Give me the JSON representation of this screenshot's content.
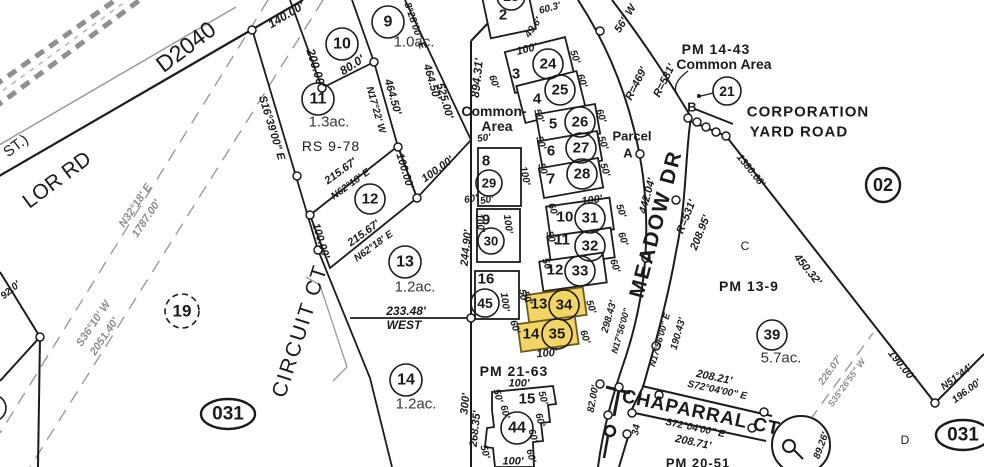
{
  "canvas": {
    "width": 984,
    "height": 467
  },
  "colors": {
    "ink": "#1b1b1b",
    "gray_line": "#9a9a9a",
    "gray_text": "#8c8c8c",
    "acre_text": "#383838",
    "highlight_fill": "#f2d469",
    "highlight_stroke": "#6b5a1d"
  },
  "map_names": {
    "roads": [
      "D2040",
      "LOR RD",
      "ST.)",
      "MEADOW DR",
      "CIRCUIT CT",
      "CHAPARRAL CT",
      "CORPORATION YARD ROAD"
    ],
    "references": [
      "PM 14-43",
      "PM 13-9",
      "PM 21-63",
      "PM 20-51",
      "RS 9-78"
    ],
    "highlighted_parcels": [
      "34",
      "35"
    ]
  },
  "parcel_circles": [
    {
      "n": "9",
      "x": 388,
      "y": 22,
      "r": 16
    },
    {
      "n": "10",
      "x": 342,
      "y": 44,
      "r": 16
    },
    {
      "n": "11",
      "x": 318,
      "y": 99,
      "r": 16
    },
    {
      "n": "12",
      "x": 370,
      "y": 199,
      "r": 15
    },
    {
      "n": "13",
      "x": 405,
      "y": 262,
      "r": 16
    },
    {
      "n": "14",
      "x": 406,
      "y": 380,
      "r": 16
    },
    {
      "n": "19",
      "x": 182,
      "y": 311,
      "r": 17,
      "dash": 1
    },
    {
      "n": "21",
      "x": 727,
      "y": 91,
      "r": 14
    },
    {
      "n": "23",
      "x": 511,
      "y": -4,
      "r": 14
    },
    {
      "n": "24",
      "x": 548,
      "y": 64,
      "r": 15
    },
    {
      "n": "25",
      "x": 560,
      "y": 90,
      "r": 15
    },
    {
      "n": "26",
      "x": 580,
      "y": 122,
      "r": 15
    },
    {
      "n": "27",
      "x": 581,
      "y": 148,
      "r": 15
    },
    {
      "n": "28",
      "x": 582,
      "y": 174,
      "r": 15
    },
    {
      "n": "29",
      "x": 489,
      "y": 183,
      "r": 13
    },
    {
      "n": "30",
      "x": 491,
      "y": 241,
      "r": 13
    },
    {
      "n": "31",
      "x": 590,
      "y": 218,
      "r": 15
    },
    {
      "n": "32",
      "x": 590,
      "y": 246,
      "r": 15
    },
    {
      "n": "33",
      "x": 580,
      "y": 271,
      "r": 15
    },
    {
      "n": "34",
      "x": 564,
      "y": 305,
      "r": 15,
      "hl": 1
    },
    {
      "n": "35",
      "x": 557,
      "y": 334,
      "r": 15,
      "hl": 1
    },
    {
      "n": "39",
      "x": 772,
      "y": 335,
      "r": 15
    },
    {
      "n": "44",
      "x": 517,
      "y": 428,
      "r": 16
    },
    {
      "n": "45",
      "x": 485,
      "y": 303,
      "r": 14
    },
    {
      "n": "02",
      "x": 883,
      "y": 185,
      "r": 17,
      "big": 1
    },
    {
      "n": "",
      "x": -7,
      "y": 408,
      "r": 13
    }
  ],
  "ellipse_badges": [
    {
      "n": "031",
      "x": 228,
      "y": 414,
      "rx": 27,
      "ry": 15
    },
    {
      "n": "031",
      "x": 963,
      "y": 435,
      "rx": 27,
      "ry": 15
    }
  ],
  "lots": [
    {
      "id": "2",
      "x": 486,
      "y": -8,
      "w": 46,
      "h": 42,
      "rot": -12
    },
    {
      "id": "3",
      "x": 509,
      "y": 44,
      "w": 62,
      "h": 42,
      "rot": -14
    },
    {
      "id": "4",
      "x": 520,
      "y": 78,
      "w": 62,
      "h": 38,
      "rot": -14
    },
    {
      "id": "5",
      "x": 538,
      "y": 109,
      "w": 60,
      "h": 30,
      "rot": -10
    },
    {
      "id": "6",
      "x": 540,
      "y": 136,
      "w": 60,
      "h": 30,
      "rot": -10
    },
    {
      "id": "7",
      "x": 541,
      "y": 163,
      "w": 60,
      "h": 30,
      "rot": -10
    },
    {
      "id": "8",
      "x": 478,
      "y": 148,
      "w": 43,
      "h": 58,
      "rot": 0
    },
    {
      "id": "9",
      "x": 477,
      "y": 209,
      "w": 43,
      "h": 53,
      "rot": 0
    },
    {
      "id": "16",
      "x": 475,
      "y": 271,
      "w": 44,
      "h": 48,
      "rot": 0
    },
    {
      "id": "10",
      "x": 548,
      "y": 202,
      "w": 64,
      "h": 32,
      "rot": -8
    },
    {
      "id": "11",
      "x": 549,
      "y": 232,
      "w": 64,
      "h": 30,
      "rot": -8
    },
    {
      "id": "12",
      "x": 541,
      "y": 257,
      "w": 64,
      "h": 30,
      "rot": -8
    },
    {
      "id": "13",
      "x": 527,
      "y": 291,
      "w": 58,
      "h": 28,
      "rot": -8,
      "hl": 1
    },
    {
      "id": "14",
      "x": 519,
      "y": 320,
      "w": 58,
      "h": 28,
      "rot": -8,
      "hl": 1
    },
    {
      "id": "15",
      "poly": "492,392 553,386 556,404 548,405 550,422 541,423 543,441 533,442 534,467 495,467 493,448 485,447 487,428 494,427 492,410"
    }
  ],
  "labels": [
    {
      "t": "D2040",
      "x": 186,
      "y": 47,
      "r": -37,
      "s": 23,
      "k": "plain"
    },
    {
      "t": "ST.)",
      "x": 16,
      "y": 146,
      "r": -37,
      "s": 15,
      "k": "plain"
    },
    {
      "t": "LOR RD",
      "x": 57,
      "y": 180,
      "r": -37,
      "s": 21,
      "k": "plain"
    },
    {
      "t": "CIRCUIT  CT",
      "x": 300,
      "y": 331,
      "r": -72,
      "s": 21,
      "k": "plain",
      "ls": 2
    },
    {
      "t": "MEADOW  DR",
      "x": 656,
      "y": 224,
      "r": -75,
      "s": 21,
      "k": "name",
      "ls": 2
    },
    {
      "t": "CHAPARRAL  CT",
      "x": 701,
      "y": 413,
      "r": 12,
      "s": 19,
      "k": "name",
      "ls": 1
    },
    {
      "t": "CORPORATION",
      "x": 808,
      "y": 112,
      "s": 15,
      "k": "name",
      "ls": 1
    },
    {
      "t": "YARD ROAD",
      "x": 799,
      "y": 132,
      "s": 15,
      "k": "name",
      "ls": 1
    },
    {
      "t": "PM 14-43",
      "x": 716,
      "y": 49,
      "s": 14,
      "k": "name",
      "ls": 1
    },
    {
      "t": "Common Area",
      "x": 724,
      "y": 64,
      "s": 14,
      "k": "name"
    },
    {
      "t": "Common-",
      "x": 494,
      "y": 111,
      "s": 14,
      "k": "name"
    },
    {
      "t": "Area",
      "x": 497,
      "y": 126,
      "s": 14,
      "k": "name"
    },
    {
      "t": "Parcel",
      "x": 632,
      "y": 136,
      "s": 13,
      "k": "name"
    },
    {
      "t": "A",
      "x": 628,
      "y": 153,
      "s": 13,
      "k": "name"
    },
    {
      "t": "PM 13-9",
      "x": 749,
      "y": 286,
      "s": 14,
      "k": "name",
      "ls": 1
    },
    {
      "t": "PM 21-63",
      "x": 514,
      "y": 371,
      "s": 14,
      "k": "name",
      "ls": 1
    },
    {
      "t": "PM 20-51",
      "x": 698,
      "y": 463,
      "s": 13,
      "k": "name",
      "ls": 1
    },
    {
      "t": "RS 9-78",
      "x": 331,
      "y": 146,
      "s": 14,
      "k": "plain",
      "ls": 1
    },
    {
      "t": "B",
      "x": 692,
      "y": 107,
      "s": 13,
      "k": "name"
    },
    {
      "t": "C",
      "x": 745,
      "y": 246,
      "s": 12,
      "k": "plain"
    },
    {
      "t": "D",
      "x": 905,
      "y": 440,
      "s": 12,
      "k": "plain"
    },
    {
      "t": "WEST",
      "x": 404,
      "y": 325,
      "s": 12,
      "k": "dim"
    },
    {
      "t": "233.48'",
      "x": 406,
      "y": 311,
      "s": 12,
      "k": "dim"
    },
    {
      "t": "2",
      "x": 503,
      "y": 15,
      "s": 15,
      "k": "name"
    },
    {
      "t": "3",
      "x": 516,
      "y": 74,
      "s": 15,
      "k": "name"
    },
    {
      "t": "4",
      "x": 537,
      "y": 99,
      "s": 15,
      "k": "name"
    },
    {
      "t": "5",
      "x": 553,
      "y": 124,
      "s": 15,
      "k": "name"
    },
    {
      "t": "6",
      "x": 551,
      "y": 151,
      "s": 15,
      "k": "name"
    },
    {
      "t": "7",
      "x": 551,
      "y": 179,
      "s": 15,
      "k": "name"
    },
    {
      "t": "8",
      "x": 486,
      "y": 161,
      "s": 15,
      "k": "name"
    },
    {
      "t": "9",
      "x": 486,
      "y": 220,
      "s": 15,
      "k": "name"
    },
    {
      "t": "10",
      "x": 565,
      "y": 217,
      "s": 15,
      "k": "name"
    },
    {
      "t": "11",
      "x": 562,
      "y": 240,
      "s": 15,
      "k": "name"
    },
    {
      "t": "12",
      "x": 555,
      "y": 270,
      "s": 15,
      "k": "name"
    },
    {
      "t": "13",
      "x": 539,
      "y": 304,
      "s": 15,
      "k": "name"
    },
    {
      "t": "14",
      "x": 531,
      "y": 334,
      "s": 15,
      "k": "name"
    },
    {
      "t": "15",
      "x": 527,
      "y": 399,
      "s": 15,
      "k": "name"
    },
    {
      "t": "16",
      "x": 486,
      "y": 279,
      "s": 15,
      "k": "name"
    },
    {
      "t": "1.0ac.",
      "x": 414,
      "y": 42,
      "s": 15,
      "k": "acre"
    },
    {
      "t": "1.3ac.",
      "x": 329,
      "y": 122,
      "s": 15,
      "k": "acre"
    },
    {
      "t": "1.2ac.",
      "x": 415,
      "y": 287,
      "s": 15,
      "k": "acre"
    },
    {
      "t": "1.2ac.",
      "x": 416,
      "y": 404,
      "s": 15,
      "k": "acre"
    },
    {
      "t": "5.7ac.",
      "x": 781,
      "y": 358,
      "s": 15,
      "k": "acre"
    },
    {
      "t": "N32°18' E",
      "x": 136,
      "y": 206,
      "r": -56,
      "s": 11,
      "k": "dimg"
    },
    {
      "t": "1787.00'",
      "x": 147,
      "y": 219,
      "r": -56,
      "s": 11,
      "k": "dimg"
    },
    {
      "t": "S36°10' W",
      "x": 94,
      "y": 324,
      "r": -56,
      "s": 11,
      "k": "dimg"
    },
    {
      "t": "2051.40'",
      "x": 105,
      "y": 337,
      "r": -56,
      "s": 11,
      "k": "dimg"
    },
    {
      "t": "92.0'",
      "x": 11,
      "y": 291,
      "r": -40,
      "s": 10,
      "k": "dim"
    },
    {
      "t": "140.00'",
      "x": 286,
      "y": 15,
      "r": -31,
      "s": 12,
      "k": "dim"
    },
    {
      "t": "200.00'",
      "x": 316,
      "y": 68,
      "r": 73,
      "s": 12,
      "k": "dim"
    },
    {
      "t": "80.0'",
      "x": 352,
      "y": 65,
      "r": -33,
      "s": 12,
      "k": "dim"
    },
    {
      "t": "S16°39'00\" E",
      "x": 271,
      "y": 128,
      "r": 73,
      "s": 11,
      "k": "dim"
    },
    {
      "t": "N17°22' W",
      "x": 375,
      "y": 110,
      "r": 74,
      "s": 10,
      "k": "dim"
    },
    {
      "t": "464.50'",
      "x": 392,
      "y": 97,
      "r": 74,
      "s": 11,
      "k": "dim"
    },
    {
      "t": "464.50'",
      "x": 431,
      "y": 82,
      "r": 74,
      "s": 11,
      "k": "dim"
    },
    {
      "t": "525.00'",
      "x": 444,
      "y": 101,
      "r": 74,
      "s": 11,
      "k": "dim"
    },
    {
      "t": "8°28'00\" E",
      "x": 414,
      "y": 26,
      "r": 71,
      "s": 10,
      "k": "dim"
    },
    {
      "t": "894.31'",
      "x": 477,
      "y": 78,
      "r": -84,
      "s": 12,
      "k": "dim"
    },
    {
      "t": "49.6'",
      "x": 534,
      "y": 28,
      "r": -55,
      "s": 10,
      "k": "dim"
    },
    {
      "t": "60.3'",
      "x": 550,
      "y": 9,
      "r": -15,
      "s": 10,
      "k": "dim"
    },
    {
      "t": "215.67'",
      "x": 341,
      "y": 172,
      "r": -36,
      "s": 11,
      "k": "dim"
    },
    {
      "t": "N62°18' E",
      "x": 351,
      "y": 185,
      "r": -36,
      "s": 10,
      "k": "dim"
    },
    {
      "t": "215.67'",
      "x": 364,
      "y": 234,
      "r": -36,
      "s": 11,
      "k": "dim"
    },
    {
      "t": "N62°18' E",
      "x": 374,
      "y": 247,
      "r": -36,
      "s": 10,
      "k": "dim"
    },
    {
      "t": "100.00'",
      "x": 320,
      "y": 241,
      "r": 73,
      "s": 11,
      "k": "dim"
    },
    {
      "t": "100.00'",
      "x": 404,
      "y": 171,
      "r": 73,
      "s": 11,
      "k": "dim"
    },
    {
      "t": "100.00'",
      "x": 438,
      "y": 170,
      "r": -36,
      "s": 11,
      "k": "dim"
    },
    {
      "t": "244.90'",
      "x": 467,
      "y": 248,
      "r": -84,
      "s": 11,
      "k": "dim"
    },
    {
      "t": "300'",
      "x": 466,
      "y": 404,
      "r": -84,
      "s": 11,
      "k": "dim"
    },
    {
      "t": "268.35'",
      "x": 476,
      "y": 429,
      "r": -84,
      "s": 11,
      "k": "dim"
    },
    {
      "t": "442.04'",
      "x": 648,
      "y": 196,
      "r": -75,
      "s": 11,
      "k": "dim"
    },
    {
      "t": "R=469'",
      "x": 637,
      "y": 84,
      "r": -63,
      "s": 11,
      "k": "dim"
    },
    {
      "t": "R=531'",
      "x": 665,
      "y": 81,
      "r": -63,
      "s": 11,
      "k": "dim"
    },
    {
      "t": "R=531'",
      "x": 687,
      "y": 217,
      "r": -68,
      "s": 11,
      "k": "dim"
    },
    {
      "t": "208.95'",
      "x": 701,
      "y": 233,
      "r": -68,
      "s": 11,
      "k": "dim"
    },
    {
      "t": "56\" W",
      "x": 626,
      "y": 19,
      "r": -58,
      "s": 11,
      "k": "dim"
    },
    {
      "t": "298.43'",
      "x": 610,
      "y": 317,
      "r": -74,
      "s": 10,
      "k": "dim"
    },
    {
      "t": "N17°56'00\"",
      "x": 621,
      "y": 331,
      "r": -74,
      "s": 9,
      "k": "dim"
    },
    {
      "t": "N17°56'00\" E",
      "x": 660,
      "y": 340,
      "r": -74,
      "s": 9,
      "k": "dim"
    },
    {
      "t": "190.43'",
      "x": 679,
      "y": 334,
      "r": -74,
      "s": 10,
      "k": "dim"
    },
    {
      "t": "82.00'",
      "x": 594,
      "y": 399,
      "r": -80,
      "s": 10,
      "k": "dim"
    },
    {
      "t": "34",
      "x": 637,
      "y": 430,
      "r": -80,
      "s": 10,
      "k": "dim"
    },
    {
      "t": "208.21'",
      "x": 714,
      "y": 378,
      "r": 12,
      "s": 11,
      "k": "dim"
    },
    {
      "t": "S72°04'00\" E",
      "x": 717,
      "y": 391,
      "r": 12,
      "s": 10,
      "k": "dim"
    },
    {
      "t": "S72°04'00\" E",
      "x": 695,
      "y": 429,
      "r": 12,
      "s": 10,
      "k": "dim"
    },
    {
      "t": "208.71'",
      "x": 693,
      "y": 443,
      "r": 12,
      "s": 11,
      "k": "dim"
    },
    {
      "t": "89.26'",
      "x": 822,
      "y": 446,
      "r": -70,
      "s": 10,
      "k": "dim"
    },
    {
      "t": "226.07'",
      "x": 831,
      "y": 371,
      "r": -54,
      "s": 10,
      "k": "dimg"
    },
    {
      "t": "S35°26'55\" W",
      "x": 847,
      "y": 383,
      "r": -54,
      "s": 9,
      "k": "dimg"
    },
    {
      "t": "1380.68'",
      "x": 750,
      "y": 171,
      "r": 51,
      "s": 10,
      "k": "dim"
    },
    {
      "t": "450.32'",
      "x": 807,
      "y": 270,
      "r": 51,
      "s": 11,
      "k": "dim"
    },
    {
      "t": "190.00'",
      "x": 901,
      "y": 366,
      "r": 51,
      "s": 11,
      "k": "dim"
    },
    {
      "t": "N51°44'",
      "x": 957,
      "y": 378,
      "r": -37,
      "s": 10,
      "k": "dim"
    },
    {
      "t": "196.00'",
      "x": 967,
      "y": 392,
      "r": -37,
      "s": 10,
      "k": "dim"
    },
    {
      "t": "100'",
      "x": 527,
      "y": 50,
      "r": -14,
      "s": 11,
      "k": "dim"
    },
    {
      "t": "50'",
      "x": 574,
      "y": 57,
      "r": 72,
      "s": 10,
      "k": "dim"
    },
    {
      "t": "60'",
      "x": 493,
      "y": 82,
      "r": 72,
      "s": 10,
      "k": "dim"
    },
    {
      "t": "60'",
      "x": 581,
      "y": 81,
      "r": 72,
      "s": 10,
      "k": "dim"
    },
    {
      "t": "50'",
      "x": 538,
      "y": 116,
      "r": 72,
      "s": 10,
      "k": "dim"
    },
    {
      "t": "60'",
      "x": 600,
      "y": 116,
      "r": 72,
      "s": 10,
      "k": "dim"
    },
    {
      "t": "50'",
      "x": 540,
      "y": 143,
      "r": 72,
      "s": 10,
      "k": "dim"
    },
    {
      "t": "50'",
      "x": 602,
      "y": 143,
      "r": 72,
      "s": 10,
      "k": "dim"
    },
    {
      "t": "50'",
      "x": 542,
      "y": 170,
      "r": 72,
      "s": 10,
      "k": "dim"
    },
    {
      "t": "50'",
      "x": 604,
      "y": 170,
      "r": 72,
      "s": 10,
      "k": "dim"
    },
    {
      "t": "100'",
      "x": 592,
      "y": 201,
      "r": -8,
      "s": 11,
      "k": "dim"
    },
    {
      "t": "60'",
      "x": 552,
      "y": 210,
      "r": 72,
      "s": 10,
      "k": "dim"
    },
    {
      "t": "50'",
      "x": 620,
      "y": 211,
      "r": 72,
      "s": 10,
      "k": "dim"
    },
    {
      "t": "50'",
      "x": 550,
      "y": 238,
      "r": 72,
      "s": 10,
      "k": "dim"
    },
    {
      "t": "60'",
      "x": 622,
      "y": 239,
      "r": 72,
      "s": 10,
      "k": "dim"
    },
    {
      "t": "50'",
      "x": 546,
      "y": 265,
      "r": 72,
      "s": 10,
      "k": "dim"
    },
    {
      "t": "60'",
      "x": 614,
      "y": 266,
      "r": 72,
      "s": 10,
      "k": "dim"
    },
    {
      "t": "50'",
      "x": 526,
      "y": 298,
      "r": 72,
      "s": 10,
      "k": "dim"
    },
    {
      "t": "60'",
      "x": 514,
      "y": 327,
      "r": 72,
      "s": 10,
      "k": "dim"
    },
    {
      "t": "50'",
      "x": 590,
      "y": 307,
      "r": 72,
      "s": 10,
      "k": "dim"
    },
    {
      "t": "60'",
      "x": 584,
      "y": 337,
      "r": 72,
      "s": 10,
      "k": "dim"
    },
    {
      "t": "100'",
      "x": 547,
      "y": 354,
      "r": -5,
      "s": 11,
      "k": "dim"
    },
    {
      "t": "50'",
      "x": 484,
      "y": 139,
      "r": -8,
      "s": 10,
      "k": "dim"
    },
    {
      "t": "60'",
      "x": 471,
      "y": 200,
      "r": -10,
      "s": 10,
      "k": "dim"
    },
    {
      "t": "50'",
      "x": 487,
      "y": 201,
      "r": -10,
      "s": 10,
      "k": "dim"
    },
    {
      "t": "100'",
      "x": 524,
      "y": 176,
      "r": 78,
      "s": 10,
      "k": "dim"
    },
    {
      "t": "100'",
      "x": 479,
      "y": 223,
      "r": 82,
      "s": 10,
      "k": "dim"
    },
    {
      "t": "100'",
      "x": 507,
      "y": 224,
      "r": 82,
      "s": 10,
      "k": "dim"
    },
    {
      "t": "100'",
      "x": 504,
      "y": 302,
      "r": 82,
      "s": 10,
      "k": "dim"
    },
    {
      "t": "50'",
      "x": 522,
      "y": 296,
      "r": 82,
      "s": 10,
      "k": "dim"
    },
    {
      "t": "100'",
      "x": 519,
      "y": 384,
      "s": 11,
      "k": "dim"
    },
    {
      "t": "100'",
      "x": 513,
      "y": 462,
      "s": 11,
      "k": "dim"
    },
    {
      "t": "50'",
      "x": 497,
      "y": 396,
      "r": 75,
      "s": 10,
      "k": "dim"
    },
    {
      "t": "60'",
      "x": 504,
      "y": 412,
      "r": 75,
      "s": 10,
      "k": "dim"
    },
    {
      "t": "50'",
      "x": 542,
      "y": 398,
      "r": 75,
      "s": 10,
      "k": "dim"
    },
    {
      "t": "60'",
      "x": 539,
      "y": 420,
      "r": 75,
      "s": 10,
      "k": "dim"
    },
    {
      "t": "60'",
      "x": 532,
      "y": 436,
      "r": 75,
      "s": 10,
      "k": "dim"
    },
    {
      "t": "50'",
      "x": 484,
      "y": 452,
      "r": 75,
      "s": 10,
      "k": "dim"
    },
    {
      "t": "60'",
      "x": 530,
      "y": 456,
      "r": 75,
      "s": 10,
      "k": "dim"
    }
  ]
}
